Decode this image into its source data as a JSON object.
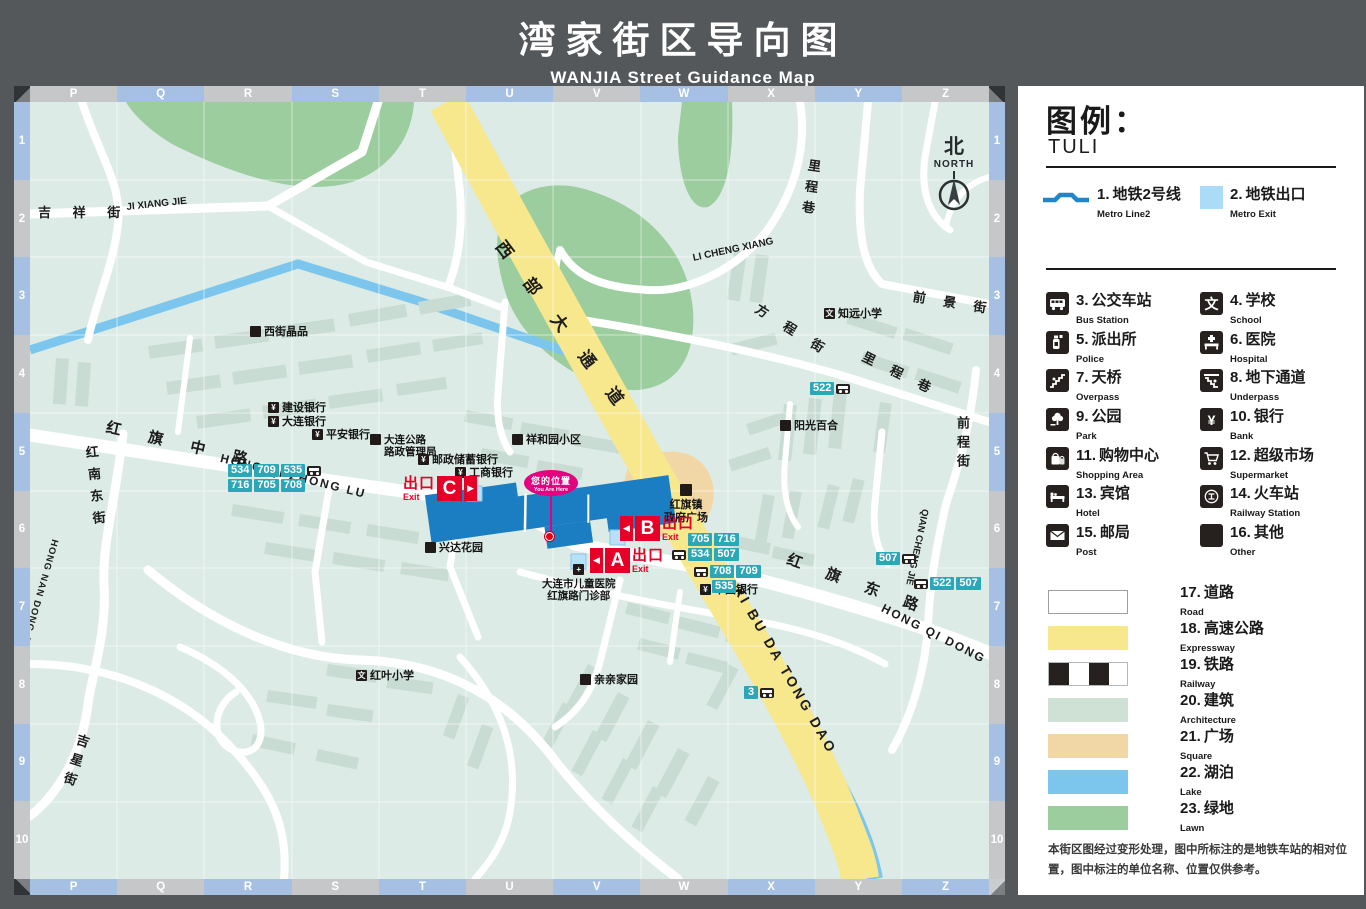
{
  "title": {
    "zh": "湾家街区导向图",
    "en": "WANJIA  Street Guidance Map"
  },
  "legend": {
    "heading_zh": "图例：",
    "heading_en": "TULI",
    "items": [
      {
        "num": "1.",
        "zh": "地铁2号线",
        "en": "Metro Line2"
      },
      {
        "num": "2.",
        "zh": "地铁出口",
        "en": "Metro Exit"
      },
      {
        "num": "3.",
        "zh": "公交车站",
        "en": "Bus Station"
      },
      {
        "num": "4.",
        "zh": "学校",
        "en": "School",
        "glyph": "文"
      },
      {
        "num": "5.",
        "zh": "派出所",
        "en": "Police"
      },
      {
        "num": "6.",
        "zh": "医院",
        "en": "Hospital"
      },
      {
        "num": "7.",
        "zh": "天桥",
        "en": "Overpass"
      },
      {
        "num": "8.",
        "zh": "地下通道",
        "en": "Underpass"
      },
      {
        "num": "9.",
        "zh": "公园",
        "en": "Park"
      },
      {
        "num": "10.",
        "zh": "银行",
        "en": "Bank",
        "glyph": "¥"
      },
      {
        "num": "11.",
        "zh": "购物中心",
        "en": "Shopping Area"
      },
      {
        "num": "12.",
        "zh": "超级市场",
        "en": "Supermarket"
      },
      {
        "num": "13.",
        "zh": "宾馆",
        "en": "Hotel"
      },
      {
        "num": "14.",
        "zh": "火车站",
        "en": "Railway Station"
      },
      {
        "num": "15.",
        "zh": "邮局",
        "en": "Post"
      },
      {
        "num": "16.",
        "zh": "其他",
        "en": "Other"
      }
    ],
    "areas": [
      {
        "num": "17.",
        "zh": "道路",
        "en": "Road"
      },
      {
        "num": "18.",
        "zh": "高速公路",
        "en": "Expressway"
      },
      {
        "num": "19.",
        "zh": "铁路",
        "en": "Railway"
      },
      {
        "num": "20.",
        "zh": "建筑",
        "en": "Architecture"
      },
      {
        "num": "21.",
        "zh": "广场",
        "en": "Square"
      },
      {
        "num": "22.",
        "zh": "湖泊",
        "en": "Lake"
      },
      {
        "num": "23.",
        "zh": "绿地",
        "en": "Lawn"
      }
    ],
    "note": "本街区图经过变形处理，图中所标注的是地铁车站的相对位置，图中标注的单位名称、位置仅供参考。"
  },
  "grid": {
    "cols": [
      "P",
      "Q",
      "R",
      "S",
      "T",
      "U",
      "V",
      "W",
      "X",
      "Y",
      "Z"
    ],
    "rows": [
      "1",
      "2",
      "3",
      "4",
      "5",
      "6",
      "7",
      "8",
      "9",
      "10"
    ]
  },
  "compass": {
    "zh": "北",
    "en": "NORTH"
  },
  "map": {
    "roads": {
      "jixiang_zh": "吉 祥 街",
      "jixiang_en": "JI XIANG JIE",
      "hqzl_zh": "红 旗 中 路",
      "hqzl_en": "HONG QI ZHONG LU",
      "hqdl_zh": "红 旗 东 路",
      "hqdl_en": "HONG QI DONG LU",
      "hndj_zh": "红南东街",
      "hndj_en": "HONG NAN DONG JIE",
      "jixing_zh": "吉星街",
      "xbdtd_zh": "西 部 大 通 道",
      "xbdtd_en": "XI BU DA TONG DAO",
      "lcx_zh": "里程巷",
      "lcx_en": "LI CHENG XIANG",
      "lcx2_zh": "里 程 巷",
      "fcj_zh": "方 程 街",
      "qjj_zh": "前 景 街",
      "qcj_zh": "前程街",
      "qcj_en": "QIAN CHENG JIE"
    },
    "places": {
      "xijie": "西街晶品",
      "jianshe": "建设银行",
      "dalian": "大连银行",
      "pingan": "平安银行",
      "gonglu1": "大连公路",
      "gonglu2": "路政管理局",
      "youchu": "邮政储蓄银行",
      "gongshang": "工商银行",
      "xianghe": "祥和园小区",
      "xingda": "兴达花园",
      "hosp1": "大连市儿童医院",
      "hosp2": "红旗路门诊部",
      "zhongguo": "中国银行",
      "zhen1": "红旗镇",
      "zhen2": "政府广场",
      "yangguang": "阳光百合",
      "qinqin": "亲亲家园",
      "zhiyuan": "知远小学",
      "hongye": "红叶小学"
    },
    "bus": {
      "west1": [
        "534",
        "709",
        "535"
      ],
      "west2": [
        "716",
        "705",
        "708"
      ],
      "b1": [
        "705",
        "716"
      ],
      "b2": [
        "534",
        "507"
      ],
      "a1": [
        "708",
        "709"
      ],
      "a2": [
        "535"
      ],
      "n522": [
        "522"
      ],
      "e507": [
        "507"
      ],
      "e2": [
        "522",
        "507"
      ],
      "s3": [
        "3"
      ]
    },
    "exits": {
      "word_zh": "出口",
      "word_en": "Exit",
      "a": "A",
      "b": "B",
      "c": "C",
      "tri_left": "◀",
      "tri_right": "▶"
    },
    "you_are_here": {
      "zh": "您的位置",
      "en": "You Are Here"
    },
    "glyphs": {
      "bank": "¥",
      "school": "文",
      "hospital": "+"
    }
  },
  "colors": {
    "exit_red": "#e60027",
    "bus_teal": "#2ba7b8",
    "metro_blue": "#1b7ec2",
    "metro_exit": "#aadcf7",
    "you_are_here": "#e5007f",
    "expressway": "#f7e88e",
    "lake": "#7cc6ee",
    "lawn": "#9bcd9e",
    "building": "#c9dcd3",
    "square_area": "#f1d6a6"
  }
}
